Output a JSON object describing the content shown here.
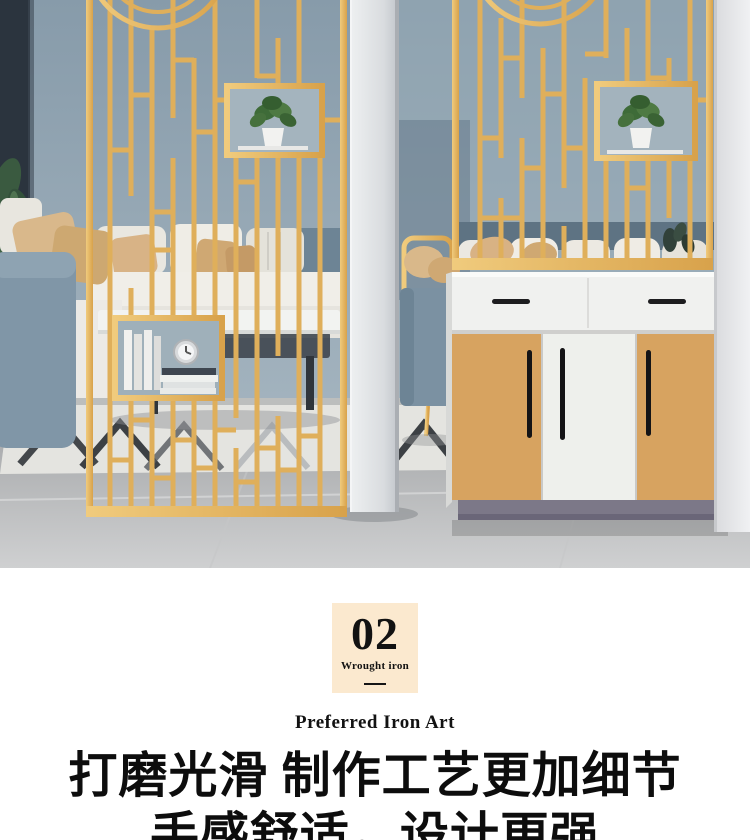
{
  "section_divider": {
    "badge": {
      "number": "02",
      "label": "Wrought iron"
    },
    "subtitle": "Preferred Iron Art",
    "headline": {
      "line1": "打磨光滑 制作工艺更加细节",
      "line2": "手感舒适，设计更强"
    }
  },
  "colors": {
    "badge_bg": "#fbe9cf",
    "gold": "#dfaf5b",
    "gold_light": "#f0cb7d",
    "gold_dark": "#d8a24b",
    "wall": "#8da1ae",
    "dark_wall": "#2b343e",
    "white_wall": "#e9eaec",
    "cabinet_white": "#f0f1ef",
    "cabinet_tan": "#d7a360",
    "plinth": "#7c7888",
    "floor": "#b5b6b9",
    "sofa_blue": "#8096a7",
    "pillow_tan": "#d9b88b",
    "text": "#121212"
  }
}
